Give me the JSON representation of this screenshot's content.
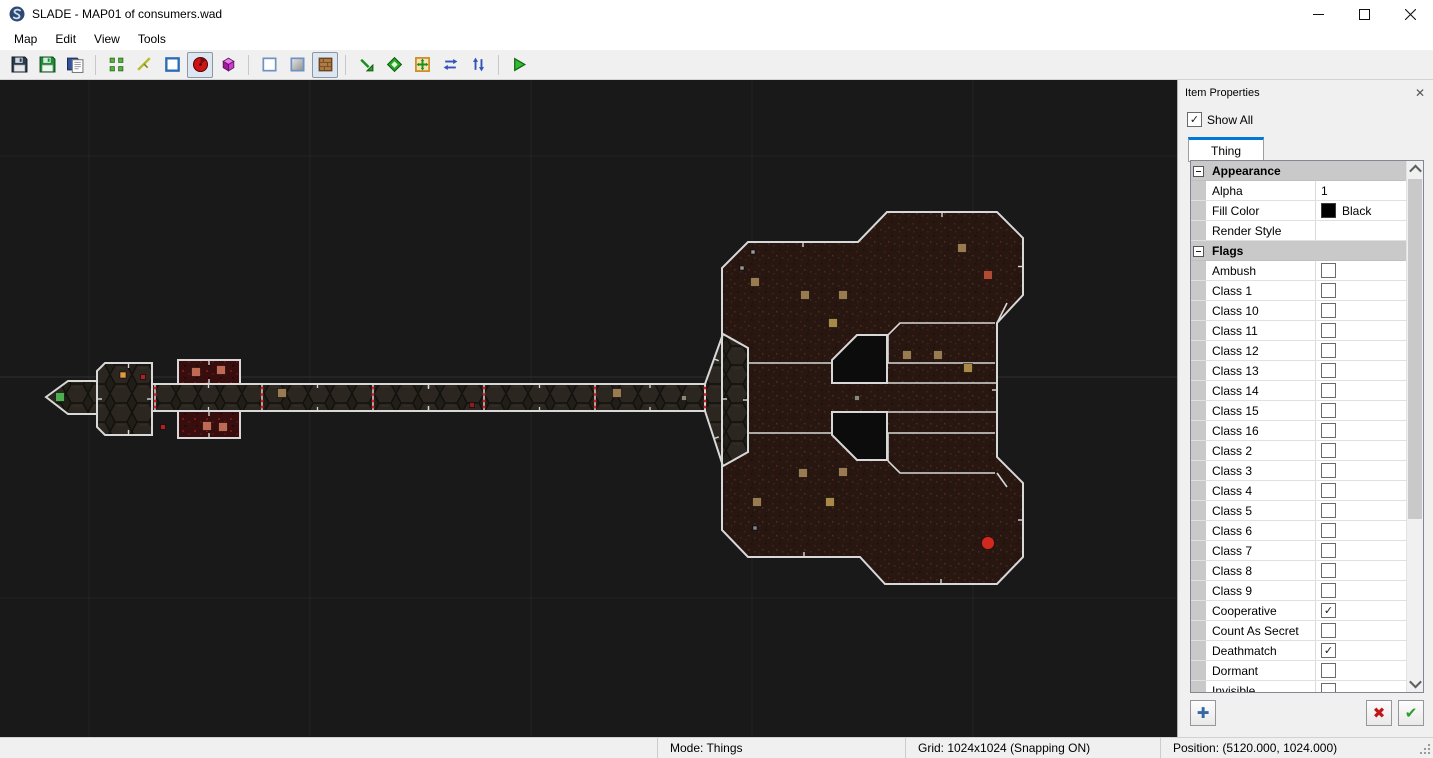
{
  "window": {
    "title": "SLADE - MAP01 of consumers.wad",
    "icon": "slade-app-icon",
    "buttons": {
      "minimize": "minimize-icon",
      "maximize": "maximize-icon",
      "close": "close-icon"
    }
  },
  "menu": {
    "items": [
      "Map",
      "Edit",
      "View",
      "Tools"
    ]
  },
  "toolbar": {
    "groups": [
      {
        "buttons": [
          {
            "name": "save-icon"
          },
          {
            "name": "save-as-icon"
          },
          {
            "name": "export-map-icon"
          }
        ]
      },
      {
        "buttons": [
          {
            "name": "vertices-mode-icon"
          },
          {
            "name": "lines-mode-icon"
          },
          {
            "name": "sectors-mode-icon"
          },
          {
            "name": "things-mode-icon",
            "active": true
          },
          {
            "name": "mode-3d-icon"
          }
        ]
      },
      {
        "buttons": [
          {
            "name": "wireframe-view-icon"
          },
          {
            "name": "flat-view-icon"
          },
          {
            "name": "textured-view-icon",
            "active": true
          }
        ]
      },
      {
        "buttons": [
          {
            "name": "draw-lines-icon"
          },
          {
            "name": "draw-shape-icon"
          },
          {
            "name": "object-edit-icon"
          },
          {
            "name": "mirror-x-icon"
          },
          {
            "name": "mirror-y-icon"
          }
        ]
      },
      {
        "buttons": [
          {
            "name": "run-map-icon"
          }
        ]
      }
    ]
  },
  "panel": {
    "title": "Item Properties",
    "close_icon": "✕",
    "show_all_label": "Show All",
    "show_all_checked": true,
    "tab": "Thing",
    "rows": [
      {
        "type": "group",
        "label": "Appearance"
      },
      {
        "type": "text",
        "label": "Alpha",
        "value": "1"
      },
      {
        "type": "color",
        "label": "Fill Color",
        "value": "Black",
        "color": "#000000"
      },
      {
        "type": "text",
        "label": "Render Style",
        "value": ""
      },
      {
        "type": "group",
        "label": "Flags"
      },
      {
        "type": "check",
        "label": "Ambush",
        "checked": false
      },
      {
        "type": "check",
        "label": "Class 1",
        "checked": false
      },
      {
        "type": "check",
        "label": "Class 10",
        "checked": false
      },
      {
        "type": "check",
        "label": "Class 11",
        "checked": false
      },
      {
        "type": "check",
        "label": "Class 12",
        "checked": false
      },
      {
        "type": "check",
        "label": "Class 13",
        "checked": false
      },
      {
        "type": "check",
        "label": "Class 14",
        "checked": false
      },
      {
        "type": "check",
        "label": "Class 15",
        "checked": false
      },
      {
        "type": "check",
        "label": "Class 16",
        "checked": false
      },
      {
        "type": "check",
        "label": "Class 2",
        "checked": false
      },
      {
        "type": "check",
        "label": "Class 3",
        "checked": false
      },
      {
        "type": "check",
        "label": "Class 4",
        "checked": false
      },
      {
        "type": "check",
        "label": "Class 5",
        "checked": false
      },
      {
        "type": "check",
        "label": "Class 6",
        "checked": false
      },
      {
        "type": "check",
        "label": "Class 7",
        "checked": false
      },
      {
        "type": "check",
        "label": "Class 8",
        "checked": false
      },
      {
        "type": "check",
        "label": "Class 9",
        "checked": false
      },
      {
        "type": "check",
        "label": "Cooperative",
        "checked": true
      },
      {
        "type": "check",
        "label": "Count As Secret",
        "checked": false
      },
      {
        "type": "check",
        "label": "Deathmatch",
        "checked": true
      },
      {
        "type": "check",
        "label": "Dormant",
        "checked": false
      },
      {
        "type": "check",
        "label": "Invisible",
        "checked": false
      }
    ],
    "buttons": {
      "add": "add-icon",
      "cancel": "cancel-icon",
      "apply": "apply-icon"
    }
  },
  "statusbar": {
    "mode": "Mode: Things",
    "grid": "Grid: 1024x1024 (Snapping ON)",
    "position": "Position: (5120.000, 1024.000)"
  },
  "map": {
    "background": "#191919",
    "grid_color": "#242424",
    "axis_color": "#2e2e2e",
    "outline_color": "#d8d8d8",
    "hole_color": "#0c0c0c",
    "dot_color": "#cc2222",
    "grid_v": [
      89,
      310,
      531,
      752,
      973,
      1194
    ],
    "grid_h": [
      76,
      297,
      518
    ],
    "rooms": [
      {
        "name": "start-room",
        "fill": "hex",
        "points": [
          [
            46,
            317
          ],
          [
            68,
            301
          ],
          [
            97,
            301
          ],
          [
            97,
            334
          ],
          [
            68,
            334
          ]
        ]
      },
      {
        "name": "entry-room",
        "fill": "hex",
        "points": [
          [
            97,
            291
          ],
          [
            105,
            283
          ],
          [
            152,
            283
          ],
          [
            152,
            355
          ],
          [
            105,
            355
          ],
          [
            97,
            347
          ]
        ]
      },
      {
        "name": "corridor",
        "fill": "hex",
        "points": [
          [
            152,
            304
          ],
          [
            705,
            304
          ],
          [
            705,
            331
          ],
          [
            152,
            331
          ]
        ]
      },
      {
        "name": "closet-north",
        "fill": "redroom",
        "points": [
          [
            178,
            280
          ],
          [
            240,
            280
          ],
          [
            240,
            304
          ],
          [
            178,
            304
          ]
        ]
      },
      {
        "name": "closet-south",
        "fill": "redroom",
        "points": [
          [
            178,
            331
          ],
          [
            240,
            331
          ],
          [
            240,
            358
          ],
          [
            178,
            358
          ]
        ]
      },
      {
        "name": "main-hall",
        "fill": "speckle",
        "points": [
          [
            748,
            162
          ],
          [
            858,
            162
          ],
          [
            887,
            132
          ],
          [
            997,
            132
          ],
          [
            1023,
            158
          ],
          [
            1023,
            215
          ],
          [
            997,
            243
          ],
          [
            997,
            377
          ],
          [
            1023,
            403
          ],
          [
            1023,
            477
          ],
          [
            997,
            504
          ],
          [
            885,
            504
          ],
          [
            860,
            477
          ],
          [
            748,
            477
          ],
          [
            722,
            450
          ],
          [
            722,
            188
          ]
        ]
      },
      {
        "name": "junction",
        "fill": "hex",
        "points": [
          [
            705,
            304
          ],
          [
            723,
            254
          ],
          [
            748,
            268
          ],
          [
            748,
            372
          ],
          [
            723,
            386
          ],
          [
            705,
            331
          ]
        ]
      }
    ],
    "holes": [
      {
        "points": [
          [
            857,
            255
          ],
          [
            887,
            255
          ],
          [
            887,
            303
          ],
          [
            832,
            303
          ],
          [
            832,
            280
          ]
        ]
      },
      {
        "points": [
          [
            832,
            332
          ],
          [
            887,
            332
          ],
          [
            887,
            380
          ],
          [
            857,
            380
          ],
          [
            832,
            355
          ]
        ]
      }
    ],
    "inner_lines": [
      [
        [
          748,
          283
        ],
        [
          832,
          283
        ]
      ],
      [
        [
          748,
          353
        ],
        [
          832,
          353
        ]
      ],
      [
        [
          887,
          283
        ],
        [
          995,
          283
        ]
      ],
      [
        [
          887,
          353
        ],
        [
          995,
          353
        ]
      ],
      [
        [
          887,
          303
        ],
        [
          997,
          303
        ]
      ],
      [
        [
          887,
          332
        ],
        [
          997,
          332
        ]
      ],
      [
        [
          888,
          255
        ],
        [
          900,
          243
        ],
        [
          995,
          243
        ]
      ],
      [
        [
          888,
          255
        ],
        [
          888,
          283
        ]
      ],
      [
        [
          888,
          381
        ],
        [
          900,
          393
        ],
        [
          995,
          393
        ]
      ],
      [
        [
          888,
          353
        ],
        [
          888,
          381
        ]
      ],
      [
        [
          997,
          243
        ],
        [
          1007,
          223
        ]
      ],
      [
        [
          997,
          393
        ],
        [
          1007,
          407
        ]
      ]
    ],
    "dividers": {
      "xs": [
        155,
        262,
        373,
        484,
        595,
        705
      ],
      "y1": 304,
      "y2": 331
    },
    "things": [
      {
        "x": 60,
        "y": 317,
        "c": "#4fae4f",
        "s": 9,
        "name": "player-start"
      },
      {
        "x": 123,
        "y": 295,
        "c": "#e09a40",
        "s": 6,
        "name": "candelabra"
      },
      {
        "x": 143,
        "y": 297,
        "c": "#aa2222",
        "s": 5,
        "name": "decoration"
      },
      {
        "x": 163,
        "y": 347,
        "c": "#aa2222",
        "s": 5,
        "name": "decoration"
      },
      {
        "x": 196,
        "y": 292,
        "c": "#c06a55",
        "s": 9,
        "name": "monster"
      },
      {
        "x": 221,
        "y": 290,
        "c": "#c06a55",
        "s": 9,
        "name": "monster"
      },
      {
        "x": 207,
        "y": 346,
        "c": "#c06a55",
        "s": 9,
        "name": "monster"
      },
      {
        "x": 223,
        "y": 347,
        "c": "#c06a55",
        "s": 9,
        "name": "monster"
      },
      {
        "x": 282,
        "y": 313,
        "c": "#9a7a50",
        "s": 9,
        "name": "monster"
      },
      {
        "x": 472,
        "y": 325,
        "c": "#8a1f1f",
        "s": 5,
        "name": "decoration"
      },
      {
        "x": 617,
        "y": 313,
        "c": "#9a7a50",
        "s": 9,
        "name": "monster"
      },
      {
        "x": 684,
        "y": 318,
        "c": "#8a8a74",
        "s": 5,
        "name": "weapon"
      },
      {
        "x": 753,
        "y": 172,
        "c": "#9a9a9a",
        "s": 4,
        "name": "item"
      },
      {
        "x": 742,
        "y": 188,
        "c": "#9a9a9a",
        "s": 4,
        "name": "item"
      },
      {
        "x": 755,
        "y": 202,
        "c": "#9a7a50",
        "s": 9,
        "name": "monster"
      },
      {
        "x": 805,
        "y": 215,
        "c": "#9a7a50",
        "s": 9,
        "name": "monster"
      },
      {
        "x": 843,
        "y": 215,
        "c": "#9a7a50",
        "s": 9,
        "name": "monster"
      },
      {
        "x": 833,
        "y": 243,
        "c": "#a98948",
        "s": 9,
        "name": "monster"
      },
      {
        "x": 962,
        "y": 168,
        "c": "#9a7a50",
        "s": 9,
        "name": "monster"
      },
      {
        "x": 988,
        "y": 195,
        "c": "#b04a35",
        "s": 9,
        "name": "monster"
      },
      {
        "x": 907,
        "y": 275,
        "c": "#9a7a50",
        "s": 9,
        "name": "monster"
      },
      {
        "x": 938,
        "y": 275,
        "c": "#9a7a50",
        "s": 9,
        "name": "monster"
      },
      {
        "x": 968,
        "y": 288,
        "c": "#a98948",
        "s": 9,
        "name": "monster"
      },
      {
        "x": 857,
        "y": 318,
        "c": "#8a8a74",
        "s": 5,
        "name": "weapon"
      },
      {
        "x": 803,
        "y": 393,
        "c": "#9a7a50",
        "s": 9,
        "name": "monster"
      },
      {
        "x": 843,
        "y": 392,
        "c": "#9a7a50",
        "s": 9,
        "name": "monster"
      },
      {
        "x": 757,
        "y": 422,
        "c": "#9a7a50",
        "s": 9,
        "name": "monster"
      },
      {
        "x": 830,
        "y": 422,
        "c": "#a98948",
        "s": 9,
        "name": "monster"
      },
      {
        "x": 755,
        "y": 448,
        "c": "#888888",
        "s": 4,
        "name": "item"
      },
      {
        "x": 988,
        "y": 463,
        "c": "#d02a20",
        "s": 13,
        "name": "cacodemon"
      }
    ]
  }
}
